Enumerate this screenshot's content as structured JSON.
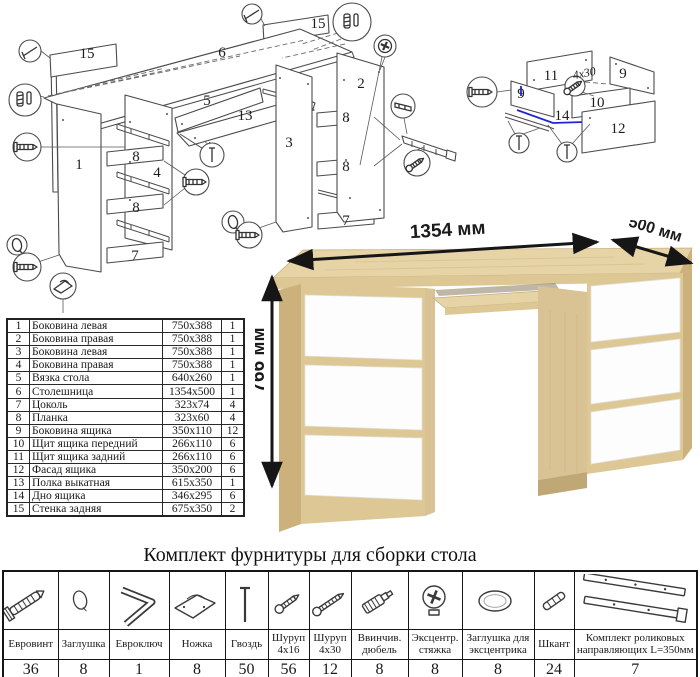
{
  "title": "Комплект фурнитуры для сборки стола",
  "desk": {
    "width_label": "1354 мм",
    "depth_label": "500 мм",
    "height_label": "766 мм"
  },
  "colors": {
    "oak_top": "#e6d3a6",
    "oak_front": "#ddc795",
    "oak_side": "#cdb17c",
    "oak_inner": "#d9c293",
    "drawer_white": "#fdfdfd",
    "highlight_blue": "#2323d6"
  },
  "parts": {
    "rows": [
      {
        "n": "1",
        "name": "Боковина левая",
        "size": "750x388",
        "q": "1"
      },
      {
        "n": "2",
        "name": "Боковина правая",
        "size": "750x388",
        "q": "1"
      },
      {
        "n": "3",
        "name": "Боковина левая",
        "size": "750x388",
        "q": "1"
      },
      {
        "n": "4",
        "name": "Боковина правая",
        "size": "750x388",
        "q": "1"
      },
      {
        "n": "5",
        "name": "Вязка стола",
        "size": "640x260",
        "q": "1"
      },
      {
        "n": "6",
        "name": "Столешница",
        "size": "1354x500",
        "q": "1"
      },
      {
        "n": "7",
        "name": "Цоколь",
        "size": "323x74",
        "q": "4"
      },
      {
        "n": "8",
        "name": "Планка",
        "size": "323x60",
        "q": "4"
      },
      {
        "n": "9",
        "name": "Боковина ящика",
        "size": "350x110",
        "q": "12"
      },
      {
        "n": "10",
        "name": "Щит ящика передний",
        "size": "266x110",
        "q": "6"
      },
      {
        "n": "11",
        "name": "Щит ящика задний",
        "size": "266x110",
        "q": "6"
      },
      {
        "n": "12",
        "name": "Фасад ящика",
        "size": "350x200",
        "q": "6"
      },
      {
        "n": "13",
        "name": "Полка выкатная",
        "size": "615x350",
        "q": "1"
      },
      {
        "n": "14",
        "name": "Дно ящика",
        "size": "346x295",
        "q": "6"
      },
      {
        "n": "15",
        "name": "Стенка задняя",
        "size": "675x350",
        "q": "2"
      }
    ]
  },
  "hardware": {
    "items": [
      {
        "name": "Евровинт",
        "qty": "36"
      },
      {
        "name": "Заглушка",
        "qty": "8"
      },
      {
        "name": "Евроключ",
        "qty": "1"
      },
      {
        "name": "Ножка",
        "qty": "8"
      },
      {
        "name": "Гвоздь",
        "qty": "50"
      },
      {
        "name": "Шуруп 4х16",
        "qty": "56"
      },
      {
        "name": "Шуруп 4х30",
        "qty": "12"
      },
      {
        "name": "Ввинчив. дюбель",
        "qty": "8"
      },
      {
        "name": "Эксцентр. стяжка",
        "qty": "8"
      },
      {
        "name": "Заглушка для эксцентрика",
        "qty": "8"
      },
      {
        "name": "Шкант",
        "qty": "24"
      },
      {
        "name": "Комплект роликовых направляющих L=350мм",
        "qty": "7"
      }
    ]
  },
  "diagram": {
    "main": {
      "p15a": "15",
      "p15b": "15",
      "p6": "6",
      "p1": "1",
      "p8a": "8",
      "p4": "4",
      "p8b": "8",
      "p7a": "7",
      "p5": "5",
      "p13": "13",
      "p3": "3",
      "p2": "2",
      "p8c": "8",
      "p8d": "8",
      "p7b": "7"
    },
    "drawer": {
      "p11": "11",
      "p9a": "9",
      "p9b": "9",
      "p10": "10",
      "p14": "14",
      "p12": "12",
      "screw_note": "4х30"
    }
  }
}
